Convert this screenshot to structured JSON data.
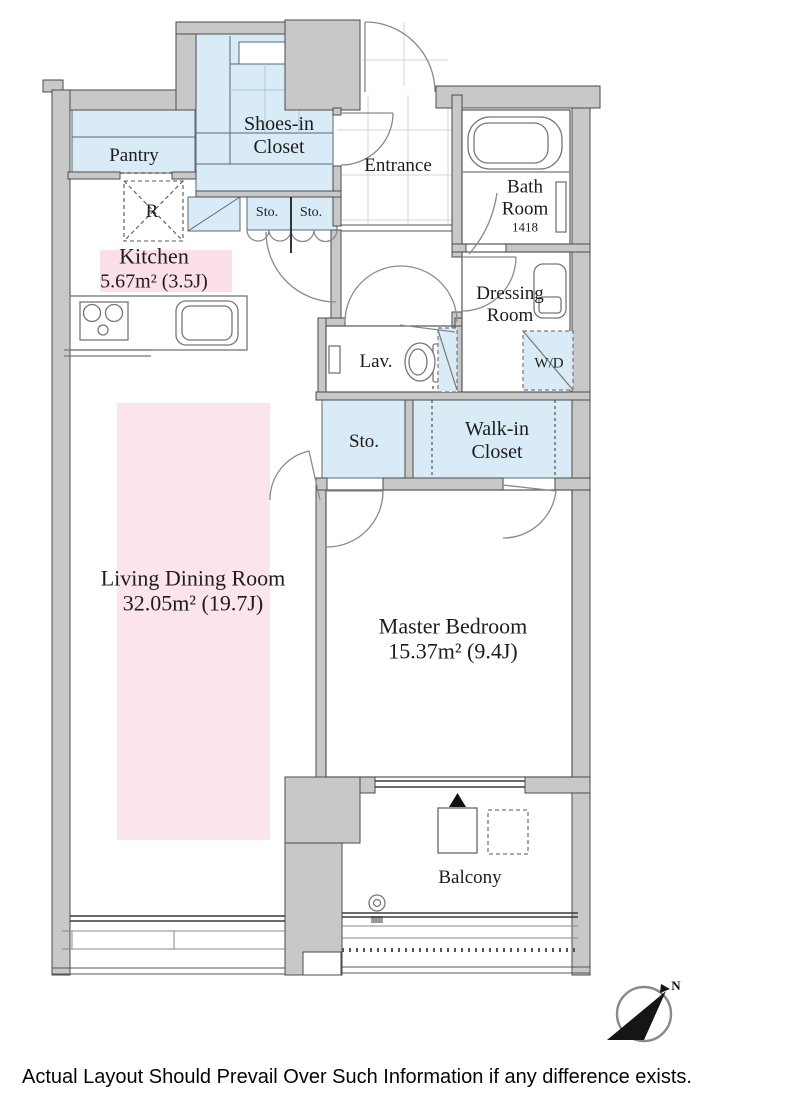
{
  "plan": {
    "rooms": {
      "pantry": {
        "label": "Pantry"
      },
      "shoes_closet": {
        "line1": "Shoes-in",
        "line2": "Closet"
      },
      "entrance": {
        "label": "Entrance"
      },
      "bath": {
        "line1": "Bath",
        "line2": "Room",
        "size": "1418"
      },
      "kitchen": {
        "label": "Kitchen",
        "area": "5.67m²  (3.5J)"
      },
      "dressing": {
        "line1": "Dressing",
        "line2": "Room"
      },
      "lav": {
        "label": "Lav."
      },
      "wd": {
        "label": "W/D"
      },
      "sto_a": {
        "label": "Sto."
      },
      "sto_b": {
        "label": "Sto."
      },
      "sto_main": {
        "label": "Sto."
      },
      "walkin_closet": {
        "line1": "Walk-in",
        "line2": "Closet"
      },
      "living_dining": {
        "label": "Living Dining Room",
        "area": "32.05m²  (19.7J)"
      },
      "master_bedroom": {
        "label": "Master Bedroom",
        "area": "15.37m²  (9.4J)"
      },
      "balcony": {
        "label": "Balcony"
      },
      "fridge": {
        "label": "R"
      }
    },
    "compass": {
      "north_label": "N"
    },
    "disclaimer": "Actual Layout Should Prevail Over Such Information if any difference exists.",
    "colors": {
      "wall_gray": "#c8c8c8",
      "closet_blue": "#d9ebf6",
      "highlight_pink": "#fbdfe9",
      "outline": "#4b4b4b"
    }
  }
}
